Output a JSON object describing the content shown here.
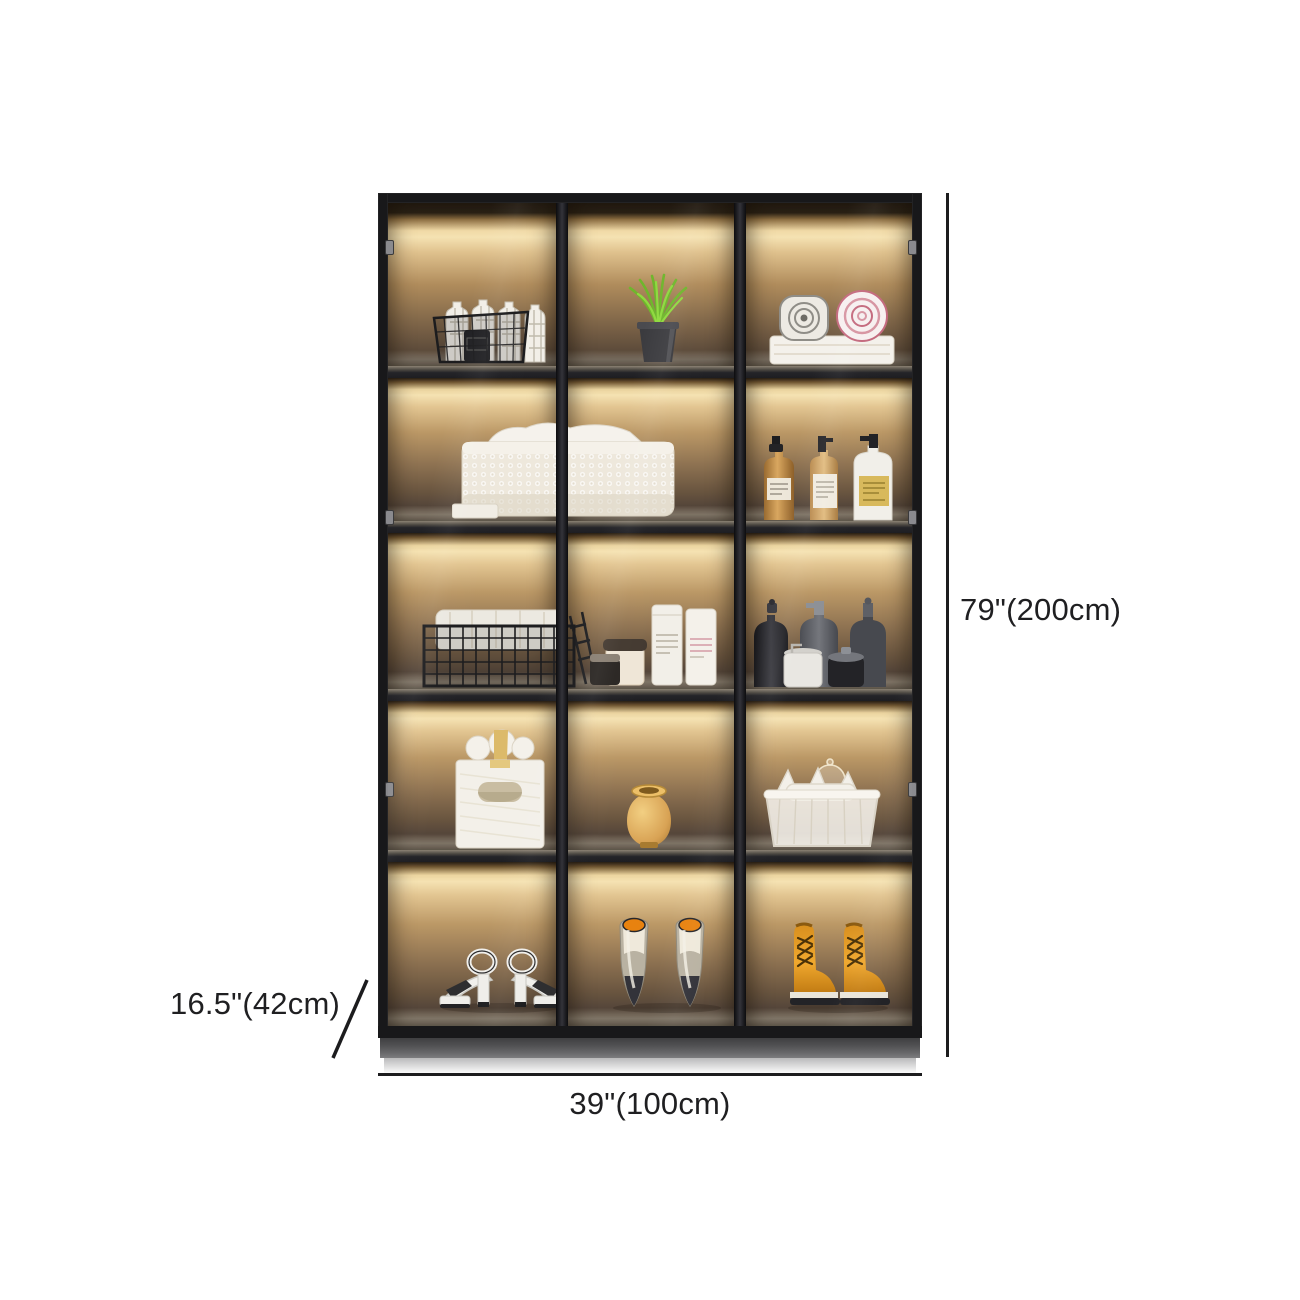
{
  "image": {
    "type": "product dimension photo",
    "subject": "black glass-door display cabinet with LED-lit shelves",
    "background": "#ffffff"
  },
  "annotations": {
    "height_label": "79\"(200cm)",
    "width_label": "39\"(100cm)",
    "depth_label": "16.5\"(42cm)",
    "line_color": "#1c1c1e",
    "text_color": "#1f1f21"
  },
  "cabinet": {
    "doors": 3,
    "rows": 5,
    "frame_color": "#18181a",
    "glow_color": "#f5e2b2",
    "shelf_color": "#242428",
    "contents": [
      [
        "black wire basket with plaid bottles and black jar",
        "green grass plant in dark metal pot",
        "gray and pink rolled towels on folded towel stack"
      ],
      [
        "white woven laundry basket with towels spanning two doors",
        "",
        "two amber pump bottles and one white pump bottle with gold label"
      ],
      [
        "black grid basket with white linens and wire rack",
        "cream jar, dark jar and two white canisters",
        "three dark dispenser bottles with white cup and dark jar"
      ],
      [
        "white embossed gift box with gold ribbon and paper rolls",
        "small gold ceramic vase",
        "clear storage basket with white items and glass lid"
      ],
      [
        "white strappy platform heels",
        "taupe pumps with orange insoles",
        "amber leather lace-up boots"
      ]
    ]
  }
}
